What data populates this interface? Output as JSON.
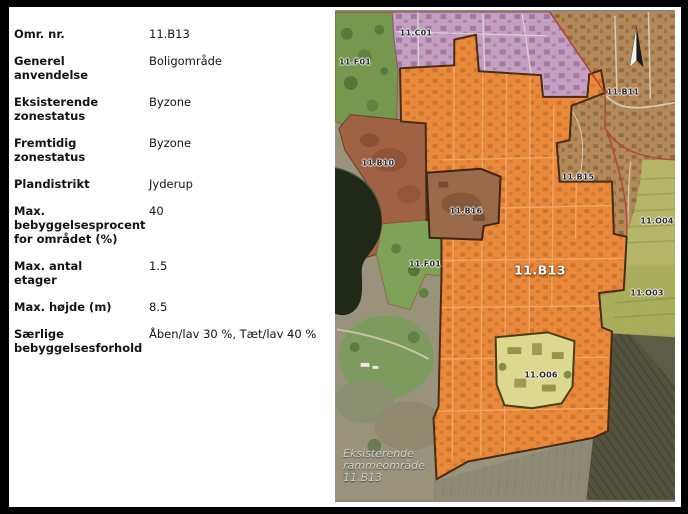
{
  "info_panel": {
    "rows": [
      {
        "label": "Omr. nr.",
        "value": "11.B13"
      },
      {
        "label": "Generel anvendelse",
        "value": "Boligområde"
      },
      {
        "label": "Eksisterende zonestatus",
        "value": "Byzone"
      },
      {
        "label": "Fremtidig zonestatus",
        "value": "Byzone"
      },
      {
        "label": "Plandistrikt",
        "value": "Jyderup"
      },
      {
        "label": "Max. bebyggelsesprocent for området (%)",
        "value": "40"
      },
      {
        "label": "Max. antal etager",
        "value": "1.5"
      },
      {
        "label": "Max. højde (m)",
        "value": "8.5"
      },
      {
        "label": "Særlige bebyggelsesforhold",
        "value": "Åben/lav 30 %, Tæt/lav 40 %"
      }
    ]
  },
  "map": {
    "highlight_label": "11.B13",
    "area_labels": [
      {
        "id": "f01-top",
        "text": "11.F01"
      },
      {
        "id": "c01",
        "text": "11.C01"
      },
      {
        "id": "b10",
        "text": "11.B10"
      },
      {
        "id": "b16",
        "text": "11.B16"
      },
      {
        "id": "b11",
        "text": "11.B11"
      },
      {
        "id": "b15",
        "text": "11.B15"
      },
      {
        "id": "o04",
        "text": "11.O04"
      },
      {
        "id": "o03",
        "text": "11.O03"
      },
      {
        "id": "f01-lake",
        "text": "11.F01"
      },
      {
        "id": "o06",
        "text": "11.O06"
      }
    ],
    "caption": {
      "lines": [
        "Eksisterende",
        "rammeområde",
        "11.B13"
      ]
    },
    "colors": {
      "highlight_zone": "#e8893c",
      "highlight_border": "#4a2a10",
      "center_zone": "#c49fc2",
      "recreation_zone": "#7da356",
      "residential_zone_b10": "#a06244",
      "enclave_b16": "#9a6a4a",
      "public_zone_o06": "#ddd88f",
      "public_zone_o04": "#b6ba6d",
      "right_residential": "#b3895a",
      "red_boundary": "#b0402f",
      "lake": "#1f2819"
    }
  }
}
